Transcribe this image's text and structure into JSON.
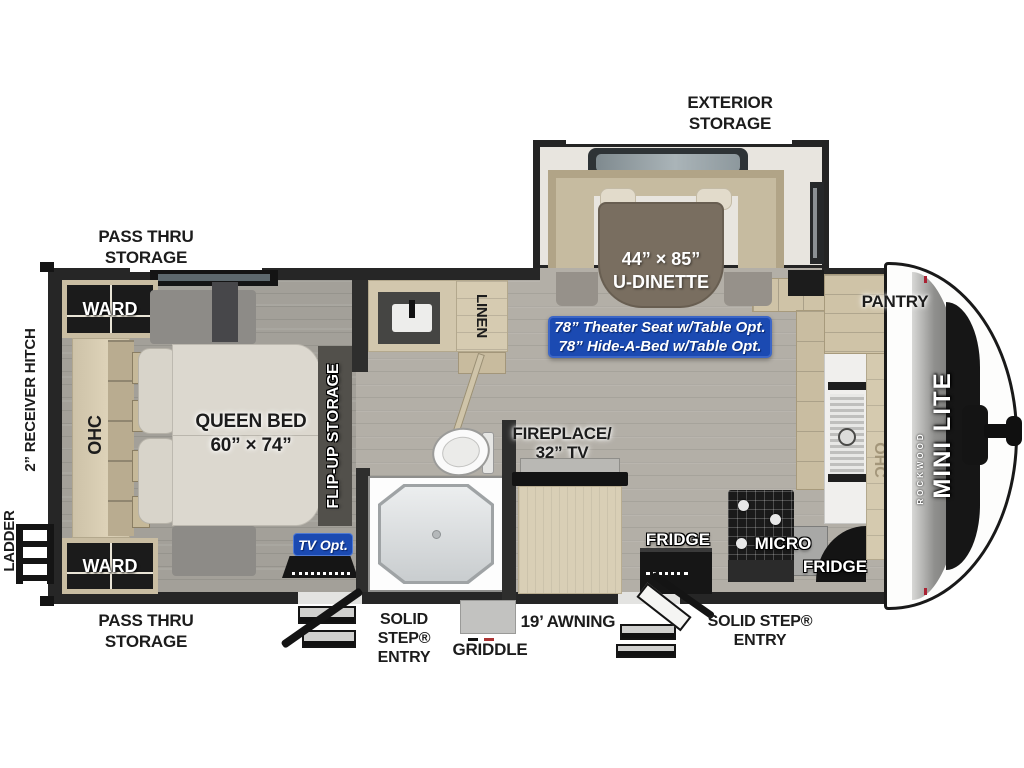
{
  "title": "Rockwood Mini Lite travel trailer floor plan",
  "colors": {
    "badge_blue": "#1b4ab2",
    "wall_dark": "#262626",
    "floor_living": "#b3afa7",
    "floor_bedroom": "#a3a099",
    "cabinet_tan": "#d2c7ad",
    "table_brown": "#796e60"
  },
  "labels": {
    "exterior_storage": [
      "EXTERIOR",
      "STORAGE"
    ],
    "pass_thru_top": [
      "PASS THRU",
      "STORAGE"
    ],
    "receiver_hitch": "2” RECEIVER HITCH",
    "ladder": "LADDER",
    "ward_top": "WARD",
    "ward_bottom": "WARD",
    "ohc_bedroom": "OHC",
    "queen_bed": [
      "QUEEN BED",
      "60” × 74”"
    ],
    "flip_up_storage": "FLIP-UP STORAGE",
    "tv_opt": "TV Opt.",
    "linen": "LINEN",
    "fireplace_tv": [
      "FIREPLACE/",
      "32” TV"
    ],
    "dinette": [
      "44” × 85”",
      "U-DINETTE"
    ],
    "options_banner": [
      "78” Theater Seat w/Table Opt.",
      "78” Hide-A-Bed w/Table Opt."
    ],
    "fridge_left": "FRIDGE",
    "fridge_right": "FRIDGE",
    "micro": "MICRO",
    "pantry": "PANTRY",
    "ohc_kitchen": "OHC",
    "brand_rockwood": "ROCKWOOD",
    "brand_model": "MINI LITE",
    "pass_thru_bottom": [
      "PASS THRU",
      "STORAGE"
    ],
    "solid_step_left": [
      "SOLID",
      "STEP®",
      "ENTRY"
    ],
    "griddle": "GRIDDLE",
    "awning": "19’ AWNING",
    "solid_step_right": [
      "SOLID STEP®",
      "ENTRY"
    ]
  }
}
